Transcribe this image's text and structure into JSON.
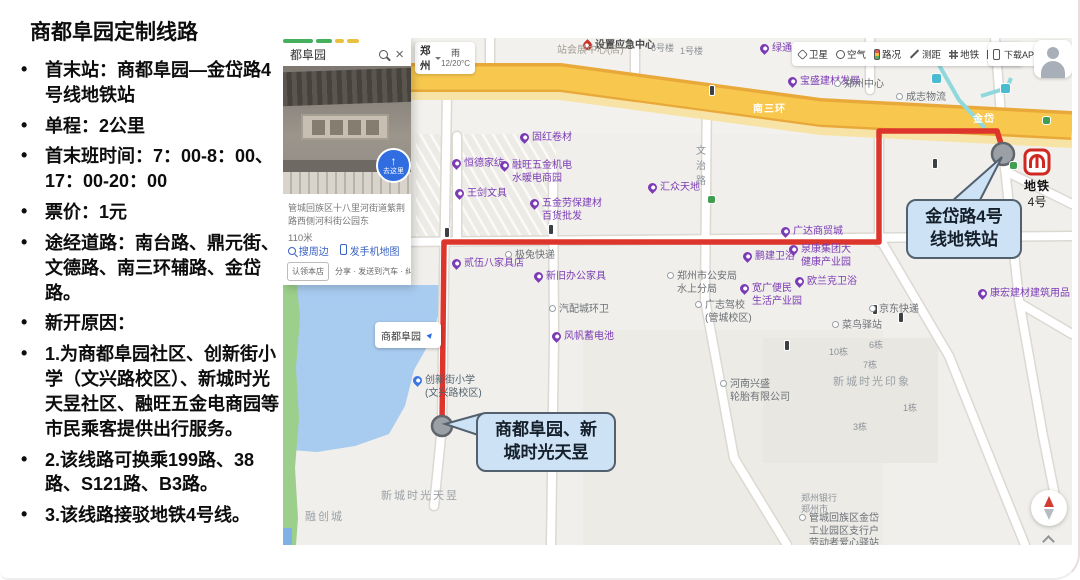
{
  "colors": {
    "route": "#dd342b",
    "highway": "#f8c84e",
    "water": "#a8cbf0",
    "callout": "#cde2f4",
    "calloutBorder": "#53606e",
    "purple": "#7a3bb5"
  },
  "sidebar": {
    "title": "商都阜园定制线路",
    "bullets": [
      "首末站：商都阜园—金岱路4号线地铁站",
      "单程：2公里",
      "首末班时间：7：00-8：00、17：00-20：00",
      "票价：1元",
      "途经道路：南台路、鼎元街、文德路、南三环辅路、金岱路。",
      "新开原因：",
      "1.为商都阜园社区、创新街小学（文兴路校区）、新城时光天昱社区、融旺五金电商园等市民乘客提供出行服务。",
      "2.该线路可换乘199路、38路、S121路、B3路。",
      "3.该线路接驳地铁4号线。"
    ]
  },
  "panel": {
    "query": "都阜园",
    "clear_icon": "×",
    "goto_arrow": "↑",
    "goto_label": "去这里",
    "address": "管城回族区十八里河街道紫荆路西侧河科街公园东",
    "distance": "110米",
    "action_nearby": "搜周边",
    "action_phone": "发手机地图",
    "claim": "认领本店",
    "share_row": "分享 · 发送到汽车 · 纠错"
  },
  "map": {
    "city": "郑州",
    "weather": "雨",
    "temp": "12/20°C",
    "download": "下载APP",
    "callout_station": "金岱路4号\n线地铁站",
    "callout_start": "商都阜园、新\n城时光天昱",
    "metro": {
      "name": "地铁",
      "line": "4号"
    },
    "fuyuan_label": "商都阜园",
    "toolbar": [
      {
        "icon": "satellite",
        "label": "卫星"
      },
      {
        "icon": "air",
        "label": "空气"
      },
      {
        "icon": "traffic",
        "label": "路况"
      },
      {
        "icon": "ruler",
        "label": "测距"
      },
      {
        "icon": "metro",
        "label": "地铁"
      },
      {
        "icon": "fullscreen",
        "label": "全屏"
      }
    ],
    "pois": [
      {
        "x": 237,
        "y": 94,
        "type": "purple",
        "text": "固红卷材"
      },
      {
        "x": 169,
        "y": 120,
        "type": "purple",
        "text": "恒德家纺"
      },
      {
        "x": 217,
        "y": 122,
        "type": "purple",
        "text": "融旺五金机电\n水暖电商园"
      },
      {
        "x": 172,
        "y": 150,
        "type": "purple",
        "text": "王剑文具"
      },
      {
        "x": 247,
        "y": 160,
        "type": "purple",
        "text": "五金劳保建材\n百货批发"
      },
      {
        "x": 365,
        "y": 144,
        "type": "purple",
        "text": "汇众天地"
      },
      {
        "x": 169,
        "y": 220,
        "type": "purple",
        "text": "贰伍八家具店"
      },
      {
        "x": 251,
        "y": 233,
        "type": "purple",
        "text": "新旧办公家具"
      },
      {
        "x": 269,
        "y": 293,
        "type": "purple",
        "text": "风帆蓄电池"
      },
      {
        "x": 498,
        "y": 188,
        "type": "purple",
        "text": "广达商贸城"
      },
      {
        "x": 460,
        "y": 213,
        "type": "purple",
        "text": "鹏建卫浴"
      },
      {
        "x": 506,
        "y": 206,
        "type": "purple",
        "text": "泉康集团大\n健康产业园"
      },
      {
        "x": 512,
        "y": 238,
        "type": "purple",
        "text": "欧兰克卫浴"
      },
      {
        "x": 457,
        "y": 245,
        "type": "purple",
        "text": "宽广便民\n生活产业园"
      },
      {
        "x": 695,
        "y": 250,
        "type": "purple",
        "text": "康宏建材建筑用品"
      },
      {
        "x": 477,
        "y": 5,
        "type": "purple",
        "text": "绿通电动车"
      },
      {
        "x": 505,
        "y": 38,
        "type": "purple",
        "text": "宝盛建材发展"
      },
      {
        "x": 551,
        "y": 41,
        "type": "dot",
        "text": "郑州中心"
      },
      {
        "x": 613,
        "y": 54,
        "type": "dot",
        "text": "成志物流"
      },
      {
        "x": 222,
        "y": 212,
        "type": "dot",
        "text": "极兔快递"
      },
      {
        "x": 266,
        "y": 266,
        "type": "dot",
        "text": "汽配城环卫"
      },
      {
        "x": 586,
        "y": 266,
        "type": "dot",
        "text": "京东快递"
      },
      {
        "x": 549,
        "y": 282,
        "type": "dot",
        "text": "菜鸟驿站"
      },
      {
        "x": 437,
        "y": 341,
        "type": "dot",
        "text": "河南兴盛\n轮胎有限公司"
      },
      {
        "x": 384,
        "y": 233,
        "type": "dot",
        "text": "郑州市公安局\n水上分局"
      },
      {
        "x": 412,
        "y": 262,
        "type": "dot",
        "text": "广志驾校\n(管城校区)"
      },
      {
        "x": 518,
        "y": 455,
        "type": "bldg",
        "text": "郑州银行\n郑州市"
      },
      {
        "x": 516,
        "y": 475,
        "type": "dot",
        "text": "管城回族区金岱\n工业园区支行户\n劳动者爱心驿站"
      },
      {
        "x": 130,
        "y": 337,
        "type": "blue",
        "text": "创新街小学\n(文兴路校区)"
      },
      {
        "x": 300,
        "y": 2,
        "type": "red",
        "text": "设置应急中心"
      },
      {
        "x": 98,
        "y": 452,
        "type": "area",
        "text": "新城时光天昱"
      },
      {
        "x": 22,
        "y": 473,
        "type": "area",
        "text": "融创城"
      },
      {
        "x": 550,
        "y": 338,
        "type": "area",
        "text": "新城时光印象"
      },
      {
        "x": 546,
        "y": 309,
        "type": "bldg",
        "text": "10栋"
      },
      {
        "x": 586,
        "y": 302,
        "type": "bldg",
        "text": "6栋"
      },
      {
        "x": 580,
        "y": 322,
        "type": "bldg",
        "text": "7栋"
      },
      {
        "x": 570,
        "y": 384,
        "type": "bldg",
        "text": "3栋"
      },
      {
        "x": 620,
        "y": 365,
        "type": "bldg",
        "text": "1栋"
      },
      {
        "x": 368,
        "y": 5,
        "type": "bldg",
        "text": "6号楼"
      },
      {
        "x": 397,
        "y": 8,
        "type": "bldg",
        "text": "1号楼"
      },
      {
        "x": 274,
        "y": 7,
        "type": "gray",
        "text": "站会展中心(店)"
      },
      {
        "x": 413,
        "y": 106,
        "type": "roadv",
        "text": "文\n治\n路"
      },
      {
        "x": 470,
        "y": 66,
        "type": "wlabel",
        "text": "南三环"
      },
      {
        "x": 690,
        "y": 76,
        "type": "wlabel",
        "text": "金岱"
      }
    ],
    "markers": [
      {
        "x": 427,
        "y": 48,
        "k": "t"
      },
      {
        "x": 162,
        "y": 190,
        "k": "t"
      },
      {
        "x": 266,
        "y": 187,
        "k": "t"
      },
      {
        "x": 590,
        "y": 267,
        "k": "t"
      },
      {
        "x": 502,
        "y": 303,
        "k": "t"
      },
      {
        "x": 616,
        "y": 275,
        "k": "t"
      },
      {
        "x": 650,
        "y": 121,
        "k": "t"
      },
      {
        "x": 425,
        "y": 158,
        "k": "g"
      },
      {
        "x": 760,
        "y": 79,
        "k": "g"
      },
      {
        "x": 727,
        "y": 124,
        "k": "g"
      },
      {
        "x": 649,
        "y": 36,
        "k": "c"
      },
      {
        "x": 718,
        "y": 46,
        "k": "c"
      }
    ]
  }
}
